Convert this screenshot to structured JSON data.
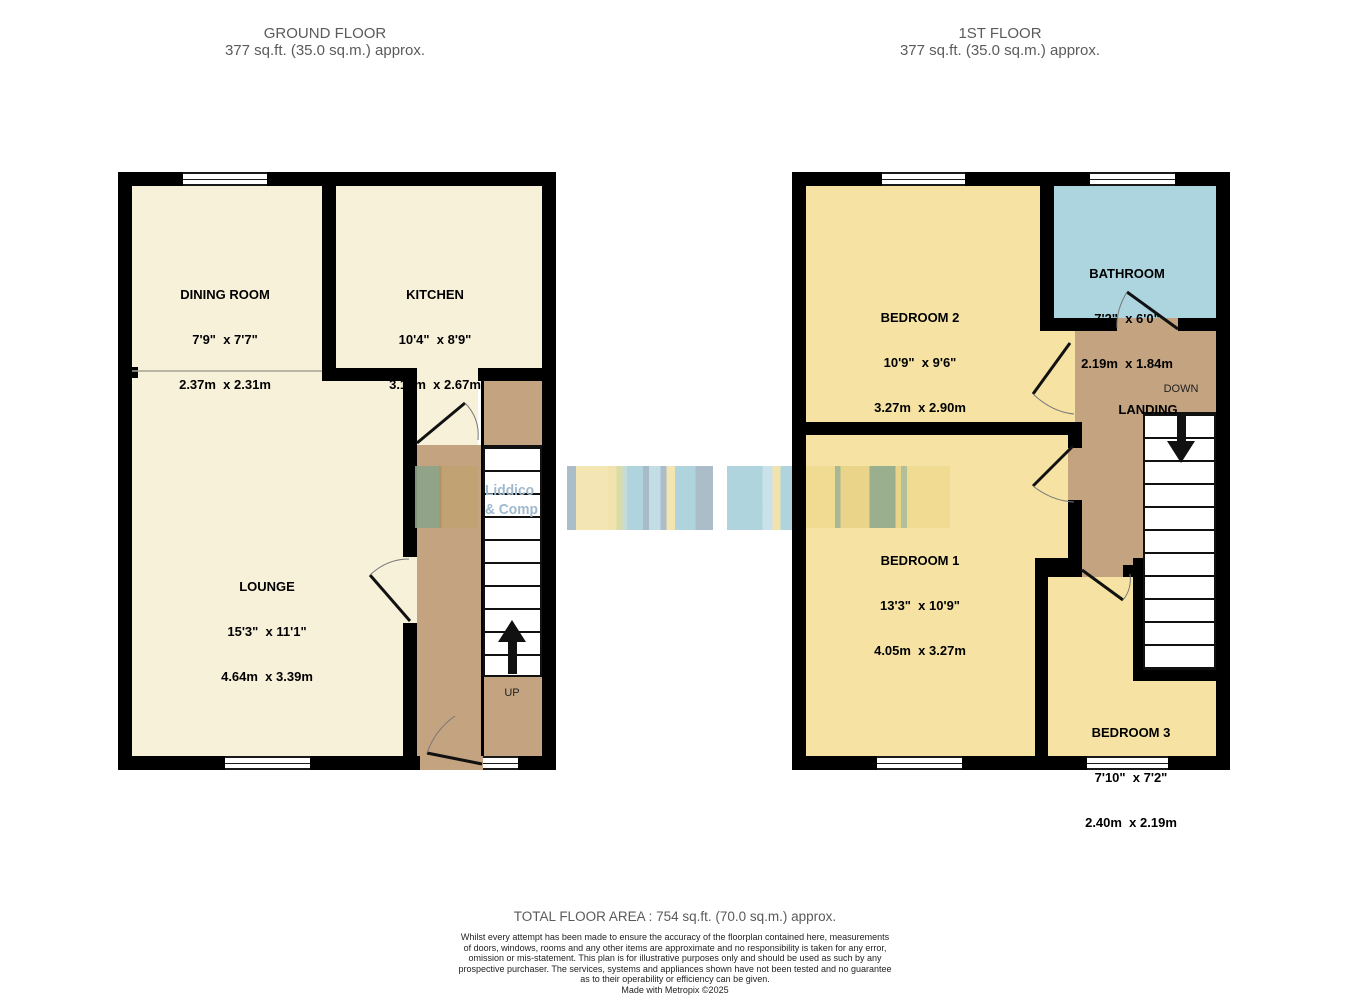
{
  "ground_floor": {
    "title": "GROUND FLOOR",
    "subtitle": "377 sq.ft. (35.0 sq.m.) approx.",
    "rooms": [
      {
        "name": "DINING ROOM",
        "imperial": "7'9\"  x 7'7\"",
        "metric": "2.37m  x 2.31m"
      },
      {
        "name": "KITCHEN",
        "imperial": "10'4\"  x 8'9\"",
        "metric": "3.14m  x 2.67m"
      },
      {
        "name": "LOUNGE",
        "imperial": "15'3\"  x 11'1\"",
        "metric": "4.64m  x 3.39m"
      }
    ],
    "stair_label": "UP"
  },
  "first_floor": {
    "title": "1ST FLOOR",
    "subtitle": "377 sq.ft. (35.0 sq.m.) approx.",
    "rooms": [
      {
        "name": "BEDROOM 2",
        "imperial": "10'9\"  x 9'6\"",
        "metric": "3.27m  x 2.90m"
      },
      {
        "name": "BATHROOM",
        "imperial": "7'2\"  x 6'0\"",
        "metric": "2.19m  x 1.84m"
      },
      {
        "name": "BEDROOM 1",
        "imperial": "13'3\"  x 10'9\"",
        "metric": "4.05m  x 3.27m"
      },
      {
        "name": "BEDROOM 3",
        "imperial": "7'10\"  x 7'2\"",
        "metric": "2.40m  x 2.19m"
      }
    ],
    "landing_label": "LANDING",
    "stair_label": "DOWN"
  },
  "watermark": {
    "line1": "Liddico",
    "line2": "& Compa"
  },
  "footer": {
    "total": "TOTAL FLOOR AREA : 754 sq.ft. (70.0 sq.m.) approx.",
    "disclaimer_lines": [
      "Whilst every attempt has been made to ensure the accuracy of the floorplan contained here, measurements",
      "of doors, windows, rooms and any other items are approximate and no responsibility is taken for any error,",
      "omission or mis-statement. This plan is for illustrative purposes only and should be used as such by any",
      "prospective purchaser. The services, systems and appliances shown have not been tested and no guarantee",
      "as to their operability or efficiency can be given."
    ],
    "credit": "Made with Metropix ©2025"
  },
  "colors": {
    "cream": "#F8F1DA",
    "yellow": "#F6E3A3",
    "bathroom_blue": "#ACD5DF",
    "hall_tan": "#C4A381",
    "wall": "#000000",
    "title_gray": "#5B5B5B",
    "watermark_text": "#9FB9CC"
  }
}
